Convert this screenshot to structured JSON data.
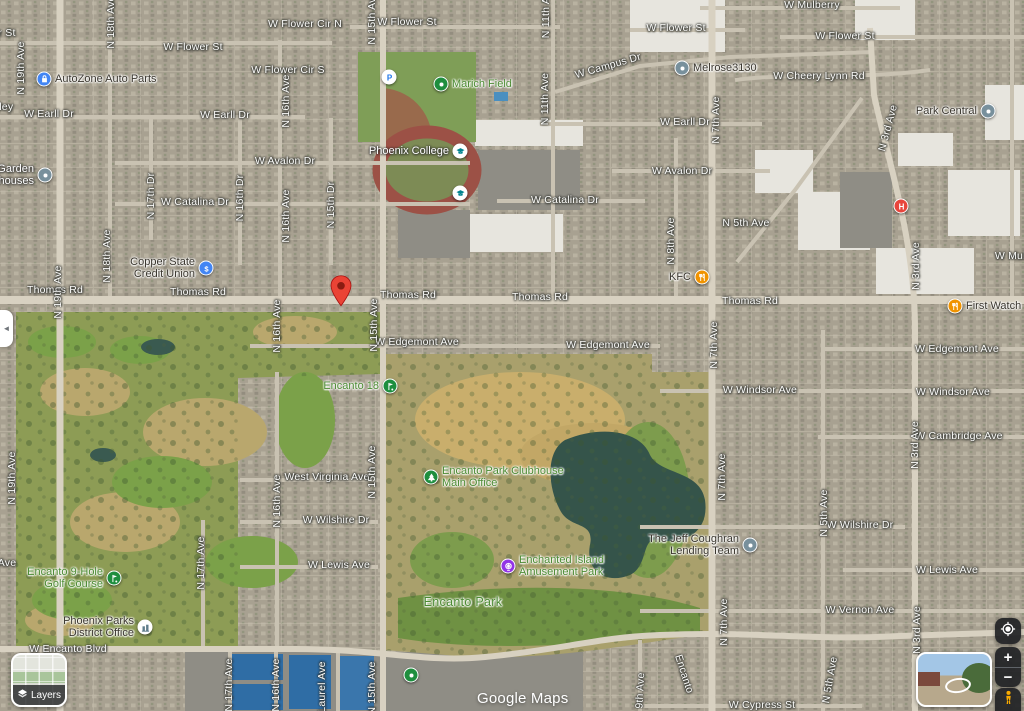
{
  "watermark": "Google Maps",
  "ui": {
    "layers_label": "Layers",
    "zoom_in": "+",
    "zoom_out": "−",
    "collapse_tab": "◄",
    "icons": {
      "layers": "layers-stack-icon",
      "collapse": "chevron-left-icon",
      "locate": "my-location-icon",
      "zoom_in": "plus-icon",
      "zoom_out": "minus-icon",
      "pegman": "pegman-icon",
      "street_view": "street-view-preview-thumbnail"
    }
  },
  "colors": {
    "street_label": "#fdfdfb",
    "park_label": "#4c8b33",
    "business_label": "#3a362e",
    "marker_blue": "#4285F4",
    "marker_gray": "#78909C",
    "marker_food": "#F09300",
    "marker_green": "#1E8E3E",
    "marker_purple": "#9334E6",
    "marker_hospital": "#E8453C",
    "marker_school_glyph": "#00838F",
    "marker_parking_glyph": "#1a73e8",
    "pin_red": "#EA4335"
  },
  "street_labels": [
    {
      "text": "r St",
      "x": 7,
      "y": 33
    },
    {
      "text": "lley",
      "x": 5,
      "y": 107
    },
    {
      "text": "W Flower Cir N",
      "x": 305,
      "y": 24
    },
    {
      "text": "W Flower St",
      "x": 193,
      "y": 47
    },
    {
      "text": "W Flower Cir S",
      "x": 288,
      "y": 70
    },
    {
      "text": "W Flower St",
      "x": 407,
      "y": 22
    },
    {
      "text": "W Flower St",
      "x": 676,
      "y": 28
    },
    {
      "text": "W Flower St",
      "x": 845,
      "y": 36
    },
    {
      "text": "W Mulberry",
      "x": 812,
      "y": 5
    },
    {
      "text": "W Cheery Lynn Rd",
      "x": 819,
      "y": 76
    },
    {
      "text": "W Campus Dr",
      "x": 608,
      "y": 66,
      "rot": -16
    },
    {
      "text": "W Earll Dr",
      "x": 49,
      "y": 114
    },
    {
      "text": "W Earll Dr",
      "x": 225,
      "y": 115
    },
    {
      "text": "W Earll Dr",
      "x": 685,
      "y": 122
    },
    {
      "text": "W Avalon Dr",
      "x": 285,
      "y": 161
    },
    {
      "text": "W Avalon Dr",
      "x": 682,
      "y": 171
    },
    {
      "text": "W Catalina Dr",
      "x": 195,
      "y": 202
    },
    {
      "text": "W Catalina Dr",
      "x": 565,
      "y": 200
    },
    {
      "text": "Thomas Rd",
      "x": 55,
      "y": 290
    },
    {
      "text": "Thomas Rd",
      "x": 198,
      "y": 292
    },
    {
      "text": "Thomas Rd",
      "x": 408,
      "y": 295
    },
    {
      "text": "Thomas Rd",
      "x": 540,
      "y": 297
    },
    {
      "text": "Thomas Rd",
      "x": 750,
      "y": 301
    },
    {
      "text": "W Edgemont Ave",
      "x": 417,
      "y": 342
    },
    {
      "text": "W Edgemont Ave",
      "x": 608,
      "y": 345
    },
    {
      "text": "W Edgemont Ave",
      "x": 957,
      "y": 349
    },
    {
      "text": "W Windsor Ave",
      "x": 760,
      "y": 390
    },
    {
      "text": "W Windsor Ave",
      "x": 953,
      "y": 392
    },
    {
      "text": "W Cambridge Ave",
      "x": 959,
      "y": 436
    },
    {
      "text": "West Virginia Ave",
      "x": 327,
      "y": 477
    },
    {
      "text": "W Wilshire Dr",
      "x": 336,
      "y": 520
    },
    {
      "text": "W Wilshire Dr",
      "x": 860,
      "y": 525
    },
    {
      "text": "W Lewis Ave",
      "x": 339,
      "y": 565
    },
    {
      "text": "W Lewis Ave",
      "x": 947,
      "y": 570
    },
    {
      "text": "W Vernon Ave",
      "x": 860,
      "y": 610
    },
    {
      "text": "W Encanto Blvd",
      "x": 68,
      "y": 649
    },
    {
      "text": "W Cypress St",
      "x": 762,
      "y": 705
    },
    {
      "text": "Encanto",
      "x": 684,
      "y": 674,
      "rot": 72
    },
    {
      "text": "W Muh",
      "x": 1012,
      "y": 256
    },
    {
      "text": "Ave",
      "x": 7,
      "y": 563
    },
    {
      "text": "N 19th Ave",
      "x": 21,
      "y": 68,
      "rot": -90
    },
    {
      "text": "N 19th Ave",
      "x": 58,
      "y": 292,
      "rot": -90
    },
    {
      "text": "N 19th Ave",
      "x": 12,
      "y": 478,
      "rot": -90
    },
    {
      "text": "N 18th Ave",
      "x": 111,
      "y": 22,
      "rot": -90
    },
    {
      "text": "N 18th Ave",
      "x": 107,
      "y": 256,
      "rot": -90
    },
    {
      "text": "N 17th Dr",
      "x": 151,
      "y": 196,
      "rot": -90
    },
    {
      "text": "N 17th Ave",
      "x": 201,
      "y": 563,
      "rot": -90
    },
    {
      "text": "N 17th Ave",
      "x": 229,
      "y": 685,
      "rot": -90
    },
    {
      "text": "N 16th Ave",
      "x": 286,
      "y": 101,
      "rot": -90
    },
    {
      "text": "N 16th Ave",
      "x": 286,
      "y": 216,
      "rot": -90
    },
    {
      "text": "N 16th Dr",
      "x": 240,
      "y": 198,
      "rot": -90
    },
    {
      "text": "N 16th Ave",
      "x": 277,
      "y": 326,
      "rot": -90
    },
    {
      "text": "N 16th Ave",
      "x": 277,
      "y": 501,
      "rot": -90
    },
    {
      "text": "N 16th Ave",
      "x": 276,
      "y": 685,
      "rot": -90
    },
    {
      "text": "N 15th Ave",
      "x": 372,
      "y": 18,
      "rot": -90
    },
    {
      "text": "N 15th Dr",
      "x": 331,
      "y": 205,
      "rot": -90
    },
    {
      "text": "N 15th Ave",
      "x": 374,
      "y": 325,
      "rot": -90
    },
    {
      "text": "N 15th Ave",
      "x": 372,
      "y": 472,
      "rot": -90
    },
    {
      "text": "N 15th Ave",
      "x": 372,
      "y": 688,
      "rot": -90
    },
    {
      "text": "N 11th Ave",
      "x": 546,
      "y": 12,
      "rot": -90
    },
    {
      "text": "N 11th Ave",
      "x": 545,
      "y": 99,
      "rot": -90
    },
    {
      "text": "Laurel Ave",
      "x": 322,
      "y": 687,
      "rot": -90
    },
    {
      "text": "N 9th Ave",
      "x": 640,
      "y": 696,
      "rot": -87
    },
    {
      "text": "N 8th Ave",
      "x": 671,
      "y": 241,
      "rot": -90
    },
    {
      "text": "N 7th Ave",
      "x": 716,
      "y": 120,
      "rot": -90
    },
    {
      "text": "N 7th Ave",
      "x": 714,
      "y": 345,
      "rot": -90
    },
    {
      "text": "N 7th Ave",
      "x": 722,
      "y": 477,
      "rot": -90
    },
    {
      "text": "N 7th Ave",
      "x": 724,
      "y": 622,
      "rot": -90
    },
    {
      "text": "N 5th Ave",
      "x": 746,
      "y": 223
    },
    {
      "text": "N 5th Ave",
      "x": 824,
      "y": 513,
      "rot": -90
    },
    {
      "text": "N 5th Ave",
      "x": 830,
      "y": 680,
      "rot": -80
    },
    {
      "text": "N 3rd Ave",
      "x": 888,
      "y": 128,
      "rot": -75
    },
    {
      "text": "N 3rd Ave",
      "x": 916,
      "y": 266,
      "rot": -90
    },
    {
      "text": "N 3rd Ave",
      "x": 915,
      "y": 445,
      "rot": -90
    },
    {
      "text": "N 3rd Ave",
      "x": 917,
      "y": 630,
      "rot": -90
    }
  ],
  "pois": [
    {
      "name": "AutoZone Auto Parts",
      "x": 44,
      "y": 79,
      "glyph": "bag",
      "color": "#4285F4",
      "side": "right",
      "tone": "biz"
    },
    {
      "lines": [
        "Garden",
        "houses"
      ],
      "name": "Garden houses",
      "x": 45,
      "y": 175,
      "glyph": "dot",
      "color": "#78909C",
      "side": "left",
      "tone": "white"
    },
    {
      "name": "Marich Field",
      "x": 441,
      "y": 84,
      "glyph": "dot",
      "color": "#1E8E3E",
      "side": "right",
      "tone": "park"
    },
    {
      "name": "Parking",
      "x": 389,
      "y": 77,
      "glyph": "P",
      "color": "#ffffff",
      "glyphColor": "#1a73e8"
    },
    {
      "name": "Phoenix College",
      "x": 460,
      "y": 151,
      "glyph": "grad",
      "color": "#ffffff",
      "glyphColor": "#00838F",
      "side": "left",
      "tone": "white"
    },
    {
      "name": "School",
      "x": 460,
      "y": 193,
      "glyph": "grad",
      "color": "#ffffff",
      "glyphColor": "#00838F"
    },
    {
      "lines": [
        "Copper State",
        "Credit Union"
      ],
      "name": "Copper State Credit Union",
      "x": 206,
      "y": 268,
      "glyph": "dollar",
      "color": "#4285F4",
      "side": "left",
      "tone": "biz"
    },
    {
      "name": "Melrose3130",
      "x": 682,
      "y": 68,
      "glyph": "dot",
      "color": "#78909C",
      "side": "right",
      "tone": "biz"
    },
    {
      "name": "Park Central",
      "x": 988,
      "y": 111,
      "glyph": "dot",
      "color": "#78909C",
      "side": "left",
      "tone": "biz"
    },
    {
      "name": "KFC",
      "x": 702,
      "y": 277,
      "glyph": "food",
      "color": "#F09300",
      "side": "left",
      "tone": "biz"
    },
    {
      "name": "First Watch",
      "x": 955,
      "y": 306,
      "glyph": "food",
      "color": "#F09300",
      "side": "right",
      "tone": "biz"
    },
    {
      "name": "Hospital",
      "x": 901,
      "y": 206,
      "glyph": "H",
      "color": "#E8453C"
    },
    {
      "name": "Destination",
      "x": 341,
      "y": 294,
      "glyph": "pin"
    },
    {
      "name": "Encanto 18",
      "x": 390,
      "y": 386,
      "glyph": "golf",
      "color": "#1E8E3E",
      "side": "left",
      "tone": "park"
    },
    {
      "lines": [
        "Encanto Park Clubhouse",
        "Main Office"
      ],
      "name": "Encanto Park Clubhouse Main Office",
      "x": 431,
      "y": 477,
      "glyph": "tree",
      "color": "#1E8E3E",
      "side": "right",
      "tone": "park"
    },
    {
      "lines": [
        "Enchanted Island",
        "Amusement Park"
      ],
      "name": "Enchanted Island Amusement Park",
      "x": 508,
      "y": 566,
      "glyph": "ferris",
      "color": "#9334E6",
      "side": "right",
      "tone": "park"
    },
    {
      "name": "Encanto Park",
      "x": 463,
      "y": 602,
      "tone": "park",
      "big": true
    },
    {
      "lines": [
        "Encanto 9-Hole",
        "Golf Course"
      ],
      "name": "Encanto 9-Hole Golf Course",
      "x": 114,
      "y": 578,
      "glyph": "golf",
      "color": "#1E8E3E",
      "side": "left",
      "tone": "park"
    },
    {
      "lines": [
        "Phoenix Parks",
        "District Office"
      ],
      "name": "Phoenix Parks District Office",
      "x": 145,
      "y": 627,
      "glyph": "bldg",
      "color": "#ffffff",
      "glyphColor": "#607D8B",
      "side": "left",
      "tone": "biz"
    },
    {
      "lines": [
        "The Jeff Coughran",
        "Lending Team"
      ],
      "name": "The Jeff Coughran Lending Team",
      "x": 750,
      "y": 545,
      "glyph": "dot",
      "color": "#78909C",
      "side": "left",
      "tone": "biz"
    },
    {
      "name": "Tennis Courts",
      "x": 411,
      "y": 675,
      "glyph": "dot",
      "color": "#1E8E3E"
    }
  ]
}
